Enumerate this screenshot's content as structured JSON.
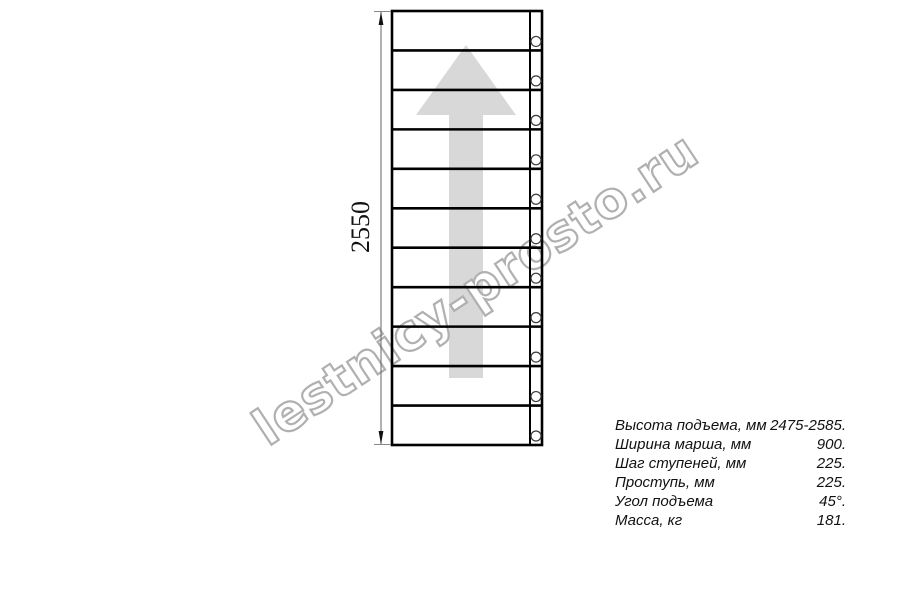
{
  "drawing": {
    "dimension_label": "2550",
    "steps": 11,
    "arrow_color": "#d8d8d8",
    "line_color": "#000000"
  },
  "watermark": {
    "text": "lestnicy-prosto.ru",
    "color": "#b0b0b0"
  },
  "specs": {
    "rows": [
      {
        "label": "Высота подъема, мм",
        "value": "2475-2585."
      },
      {
        "label": "Ширина марша, мм",
        "value": "900."
      },
      {
        "label": "Шаг ступеней, мм",
        "value": "225."
      },
      {
        "label": "Проступь, мм",
        "value": "225."
      },
      {
        "label": "Угол подъема",
        "value": "45°."
      },
      {
        "label": "Масса, кг",
        "value": "181."
      }
    ]
  }
}
